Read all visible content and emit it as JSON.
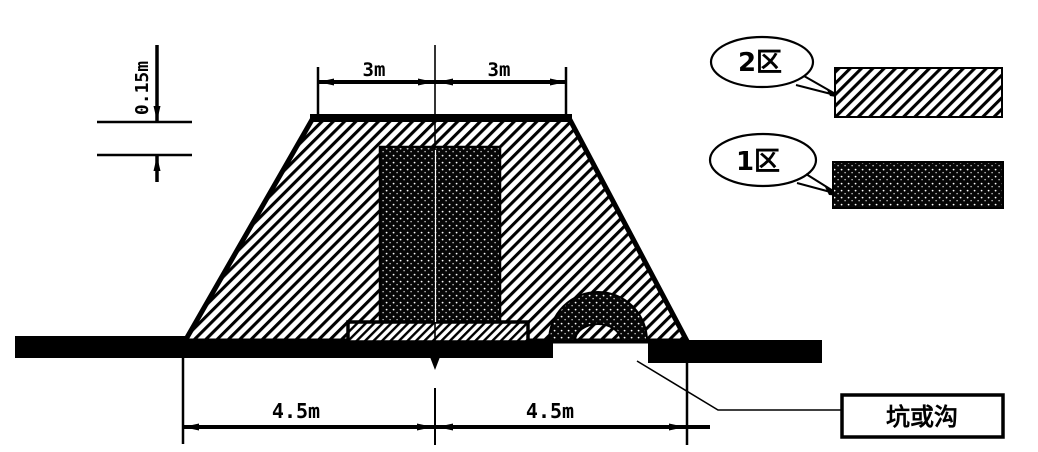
{
  "dimensions": {
    "top_left": "3m",
    "top_right": "3m",
    "thickness": "0.15m",
    "bottom_left": "4.5m",
    "bottom_right": "4.5m"
  },
  "legend": {
    "zone2_label": "2区",
    "zone1_label": "1区"
  },
  "callout": {
    "pit_label": "坑或沟"
  },
  "colors": {
    "ink": "#000000",
    "background": "#ffffff"
  }
}
